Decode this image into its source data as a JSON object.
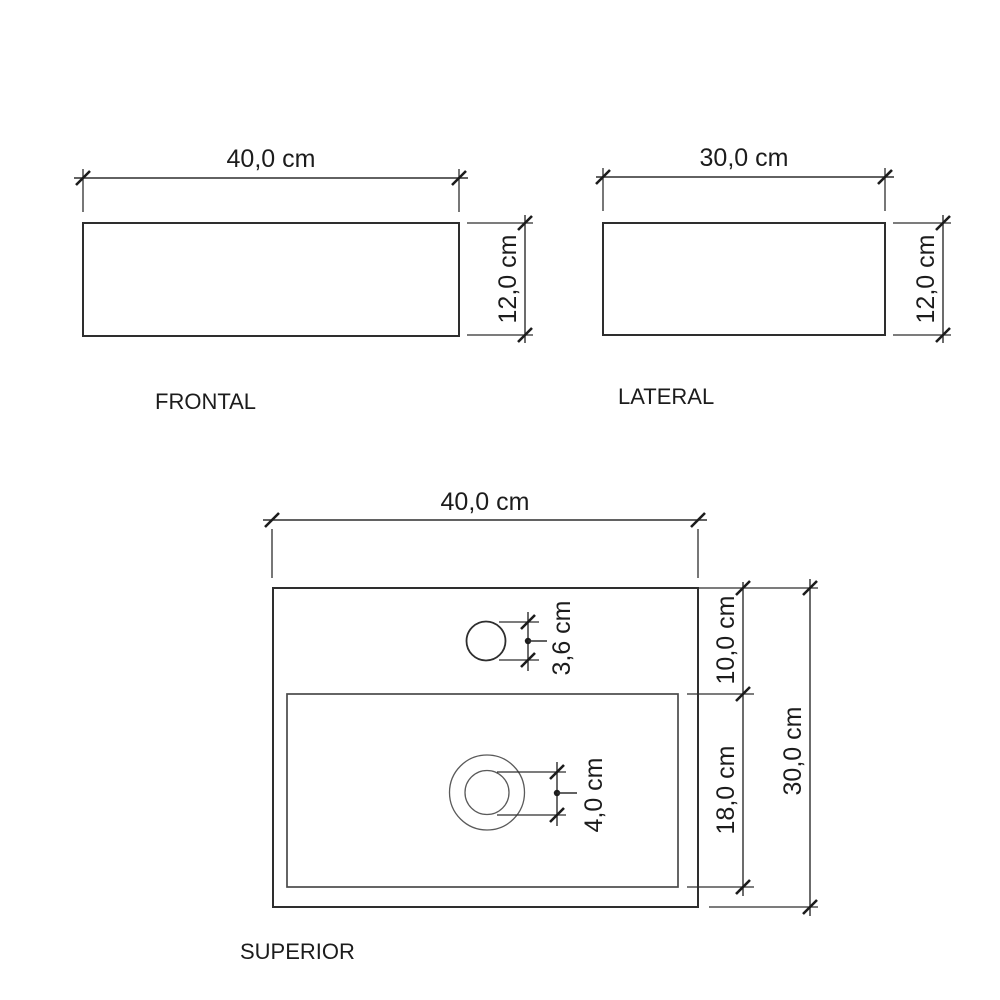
{
  "drawing": {
    "views": {
      "frontal": {
        "label": "FRONTAL",
        "width": "40,0 cm",
        "height": "12,0 cm"
      },
      "lateral": {
        "label": "LATERAL",
        "width": "30,0 cm",
        "height": "12,0 cm"
      },
      "superior": {
        "label": "SUPERIOR",
        "width": "40,0 cm",
        "faucet_band_depth": "10,0 cm",
        "basin_depth": "18,0 cm",
        "total_depth": "30,0 cm",
        "faucet_hole_diameter": "3,6 cm",
        "drain_diameter": "4,0 cm"
      }
    },
    "colors": {
      "background": "#ffffff",
      "line": "#2e2e2e",
      "thin_line": "#5a5a5a",
      "text": "#1c1c1c"
    }
  }
}
